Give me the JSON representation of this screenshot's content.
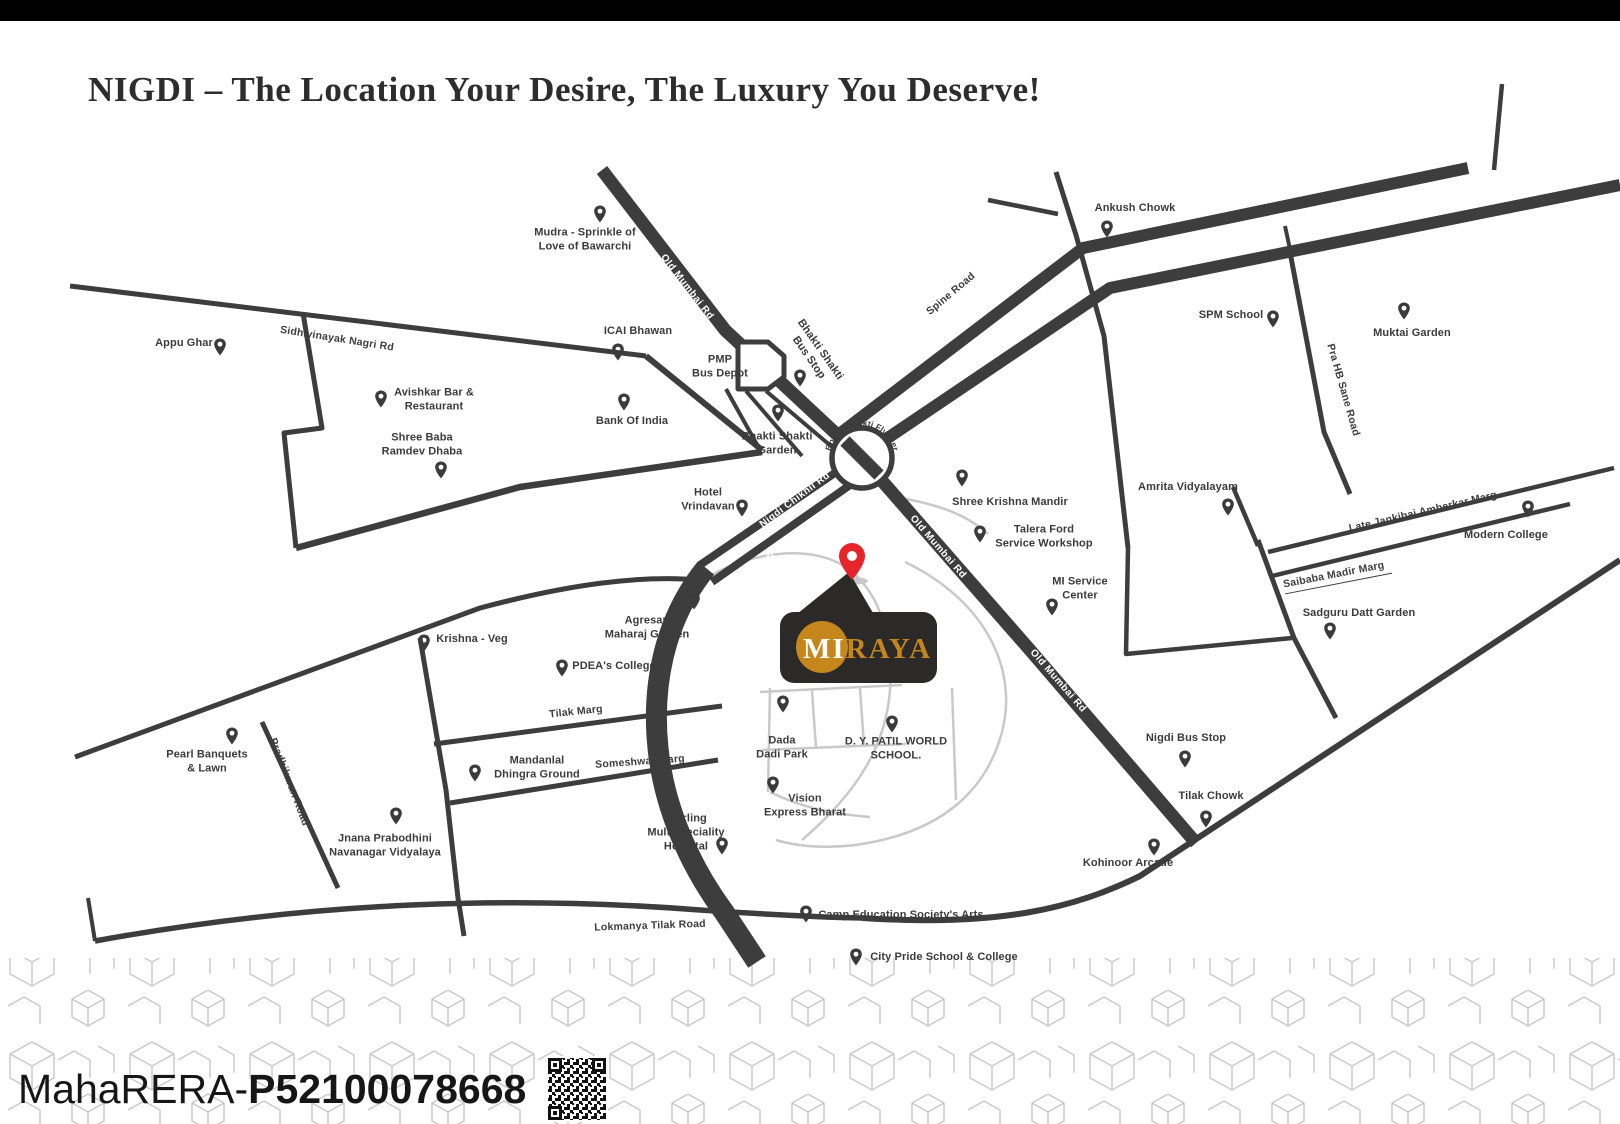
{
  "title": "NIGDI – The Location Your Desire, The Luxury You Deserve!",
  "colors": {
    "road_dark": "#3d3d3d",
    "road_light": "#c9c9c9",
    "label": "#3b3b3b",
    "logo_gold": "#c5861c",
    "logo_bg": "#2b2a28",
    "pin_red": "#e5252a"
  },
  "logo": {
    "part1": "MI",
    "part2": "RAYA"
  },
  "footer": {
    "rera_prefix": "MahaRERA-",
    "rera_number": "P52100078668"
  },
  "map": {
    "road_names": {
      "sidhivinayak": "Sidhivinayak Nagri Rd",
      "old_mumbai": "Old Mumbai Rd",
      "spine": "Spine Road",
      "nigdi_chikhli": "Nigdi Chikhli Rd",
      "flyover": "Bhakti Shakti Flyover",
      "pra_hb_sane": "Pra HB Sane Road",
      "late_jankibai": "Late Jankibai Amberkar Marg",
      "saibaba": "Saibaba Madir Marg",
      "tilak_marg": "Tilak Marg",
      "someshwar": "Someshwar Marg",
      "pradhikaran": "Pradhikaran Road",
      "lokmanya": "Lokmanya Tilak Road"
    },
    "pois": {
      "mudra": "Mudra - Sprinkle of\nLove of Bawarchi",
      "appu_ghar": "Appu Ghar",
      "icai": "ICAI Bhawan",
      "pmp": "PMP\nBus Depot",
      "bank": "Bank Of India",
      "avishkar": "Avishkar Bar &\nRestaurant",
      "shree_baba": "Shree Baba\nRamdev Dhaba",
      "bhakti_garden": "Bhakti Shakti\nGarden",
      "bhakti_bus_stop": "Bhakti Shakti\nBus Stop",
      "hotel_vrindavan": "Hotel\nVrindavan",
      "ankush": "Ankush Chowk",
      "spm": "SPM School",
      "muktai": "Muktai Garden",
      "shree_krishna": "Shree Krishna Mandir",
      "talera": "Talera Ford\nService Workshop",
      "amrita": "Amrita Vidyalayam",
      "modern": "Modern College",
      "mi_service": "MI Service\nCenter",
      "sadguru": "Sadguru Datt Garden",
      "agresan": "Agresan\nMaharaj Garden",
      "krishna_veg": "Krishna - Veg",
      "pdea": "PDEA's College",
      "pearl": "Pearl Banquets\n& Lawn",
      "mandanlal": "Mandanlal\nDhingra Ground",
      "jnana": "Jnana Prabodhini\nNavanagar Vidyalaya",
      "sterling": "Sterling\nMultispeciality\nHospital",
      "dada_dadi": "Dada\nDadi Park",
      "dy_patil": "D. Y. PATIL WORLD\nSCHOOL.",
      "vision": "Vision\nExpress Bharat",
      "nigdi_bus": "Nigdi Bus Stop",
      "tilak_chowk": "Tilak Chowk",
      "kohinoor": "Kohinoor Arcade",
      "camp": "Camp Education Society's Arts",
      "city_pride": "City Pride School & College"
    }
  }
}
